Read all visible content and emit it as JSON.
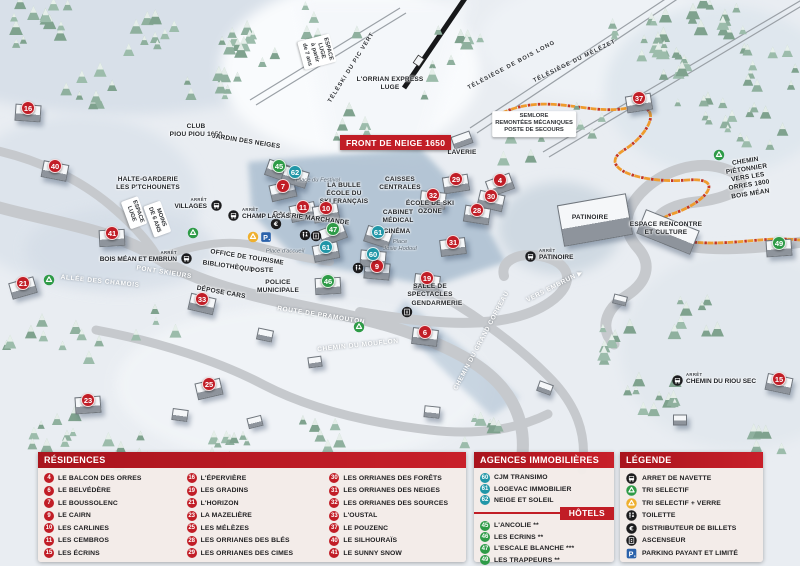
{
  "colors": {
    "red": "#c11d26",
    "green": "#2e9b47",
    "teal": "#2196a7",
    "yellow": "#efb02e",
    "blue": "#2b62ab",
    "orange": "#ef9b2d"
  },
  "map": {
    "banner": {
      "text": "FRONT DE NEIGE 1650"
    },
    "arret_label": "ARRÊT",
    "markers": [
      {
        "n": "16",
        "type": "residence",
        "x": 28,
        "y": 108
      },
      {
        "n": "40",
        "type": "residence",
        "x": 55,
        "y": 166
      },
      {
        "n": "41",
        "type": "residence",
        "x": 112,
        "y": 233
      },
      {
        "n": "21",
        "type": "residence",
        "x": 23,
        "y": 283
      },
      {
        "n": "33",
        "type": "residence",
        "x": 202,
        "y": 299
      },
      {
        "n": "23",
        "type": "residence",
        "x": 88,
        "y": 400
      },
      {
        "n": "25",
        "type": "residence",
        "x": 209,
        "y": 384
      },
      {
        "n": "7",
        "type": "residence",
        "x": 283,
        "y": 186
      },
      {
        "n": "11",
        "type": "residence",
        "x": 303,
        "y": 207
      },
      {
        "n": "10",
        "type": "residence",
        "x": 326,
        "y": 208
      },
      {
        "n": "9",
        "type": "residence",
        "x": 377,
        "y": 266
      },
      {
        "n": "29",
        "type": "residence",
        "x": 456,
        "y": 179
      },
      {
        "n": "4",
        "type": "residence",
        "x": 500,
        "y": 180
      },
      {
        "n": "32",
        "type": "residence",
        "x": 433,
        "y": 195
      },
      {
        "n": "30",
        "type": "residence",
        "x": 491,
        "y": 196
      },
      {
        "n": "28",
        "type": "residence",
        "x": 477,
        "y": 210
      },
      {
        "n": "31",
        "type": "residence",
        "x": 453,
        "y": 242
      },
      {
        "n": "19",
        "type": "residence",
        "x": 427,
        "y": 278
      },
      {
        "n": "6",
        "type": "residence",
        "x": 425,
        "y": 332
      },
      {
        "n": "37",
        "type": "residence",
        "x": 639,
        "y": 98
      },
      {
        "n": "15",
        "type": "residence",
        "x": 779,
        "y": 379
      },
      {
        "n": "45",
        "type": "hotel",
        "x": 279,
        "y": 166
      },
      {
        "n": "47",
        "type": "hotel",
        "x": 333,
        "y": 229
      },
      {
        "n": "46",
        "type": "hotel",
        "x": 328,
        "y": 281
      },
      {
        "n": "49",
        "type": "hotel",
        "x": 779,
        "y": 243
      },
      {
        "n": "62",
        "type": "agency",
        "x": 295,
        "y": 172
      },
      {
        "n": "61",
        "type": "agency",
        "x": 326,
        "y": 247
      },
      {
        "n": "61",
        "type": "agency",
        "x": 378,
        "y": 232
      },
      {
        "n": "60",
        "type": "agency",
        "x": 373,
        "y": 254
      }
    ],
    "labels": [
      {
        "text": "ESPACE\nLUGE\nà partir\nde 7 ans",
        "x": 317,
        "y": 52,
        "rot": 75,
        "style": "pill"
      },
      {
        "text": "TÉLÉSKI DU PIC VERT",
        "x": 352,
        "y": 68,
        "rot": -58,
        "style": "lift"
      },
      {
        "text": "L'ORRIAN EXPRESS\nLUGE",
        "x": 390,
        "y": 84,
        "rot": 0,
        "style": "dark"
      },
      {
        "text": "TÉLÉSIÈGE DE BOIS LONG",
        "x": 512,
        "y": 66,
        "rot": -28,
        "style": "lift"
      },
      {
        "text": "TÉLÉSIÈGE DU MÉLÉZET",
        "x": 575,
        "y": 62,
        "rot": -26,
        "style": "lift"
      },
      {
        "text": "SEMLORE\nREMONTÉES MÉCANIQUES\nPOSTE DE SECOURS",
        "x": 534,
        "y": 124,
        "rot": 0,
        "style": "pill"
      },
      {
        "text": "CLUB\nPIOU PIOU 1650",
        "x": 196,
        "y": 131,
        "rot": 0,
        "style": "dark"
      },
      {
        "text": "JARDIN DES NEIGES",
        "x": 246,
        "y": 142,
        "rot": 9,
        "style": "dark"
      },
      {
        "text": "HALTE-GARDERIE\nLES P'TCHOUNETS",
        "x": 148,
        "y": 184,
        "rot": 0,
        "style": "dark"
      },
      {
        "text": "ESPACE\nLUGE",
        "x": 134,
        "y": 213,
        "rot": 70,
        "style": "pill"
      },
      {
        "text": "MOINS\nDE 6 ANS",
        "x": 157,
        "y": 219,
        "rot": 70,
        "style": "pill"
      },
      {
        "text": "LAVERIE",
        "x": 462,
        "y": 153,
        "rot": 0,
        "style": "dark"
      },
      {
        "text": "CAISSES\nCENTRALES",
        "x": 400,
        "y": 184,
        "rot": 0,
        "style": "dark"
      },
      {
        "text": "ÉCOLE DE SKI\nOZONE",
        "x": 430,
        "y": 208,
        "rot": 0,
        "style": "dark"
      },
      {
        "text": "CABINET\nMÉDICAL",
        "x": 398,
        "y": 217,
        "rot": 0,
        "style": "dark"
      },
      {
        "text": "CINÉMA",
        "x": 397,
        "y": 232,
        "rot": 0,
        "style": "dark"
      },
      {
        "text": "Place\nJosie Hodoul",
        "x": 400,
        "y": 246,
        "rot": 0,
        "style": "place"
      },
      {
        "text": "LA BULLE\nÉCOLE DU\nSKI FRANÇAIS",
        "x": 344,
        "y": 194,
        "rot": 0,
        "style": "dark"
      },
      {
        "text": "Place du Festival",
        "x": 318,
        "y": 181,
        "rot": 0,
        "style": "place"
      },
      {
        "text": "GALERIE MARCHANDE",
        "x": 311,
        "y": 219,
        "rot": 7,
        "style": "dark"
      },
      {
        "text": "Place d'accueil",
        "x": 285,
        "y": 252,
        "rot": 0,
        "style": "place"
      },
      {
        "text": "OFFICE DE TOURISME",
        "x": 247,
        "y": 258,
        "rot": 9,
        "style": "dark"
      },
      {
        "text": "BIBLIOTHÈQUE",
        "x": 228,
        "y": 267,
        "rot": 8,
        "style": "dark"
      },
      {
        "text": "POSTE",
        "x": 262,
        "y": 271,
        "rot": 0,
        "style": "dark"
      },
      {
        "text": "POLICE\nMUNICIPALE",
        "x": 278,
        "y": 287,
        "rot": 0,
        "style": "dark"
      },
      {
        "text": "DÉPOSE CARS",
        "x": 221,
        "y": 293,
        "rot": 10,
        "style": "dark"
      },
      {
        "text": "SALLE DE\nSPECTACLES",
        "x": 430,
        "y": 291,
        "rot": 0,
        "style": "dark"
      },
      {
        "text": "GENDARMERIE",
        "x": 437,
        "y": 304,
        "rot": 0,
        "style": "dark"
      },
      {
        "text": "ALLÉE DES CHAMOIS",
        "x": 100,
        "y": 282,
        "rot": 6,
        "style": "road"
      },
      {
        "text": "PONT SKIEURS",
        "x": 164,
        "y": 273,
        "rot": 9,
        "style": "road"
      },
      {
        "text": "ROUTE DE PRAMOUTON",
        "x": 321,
        "y": 316,
        "rot": 9,
        "style": "road"
      },
      {
        "text": "CHEMIN DU MOUFLON",
        "x": 358,
        "y": 346,
        "rot": -6,
        "style": "road"
      },
      {
        "text": "CHEMIN DU GRAND CORREAU",
        "x": 482,
        "y": 341,
        "rot": -62,
        "style": "road"
      },
      {
        "text": "VERS EMBRUN ▶",
        "x": 555,
        "y": 287,
        "rot": -27,
        "style": "road"
      },
      {
        "text": "PATINOIRE",
        "x": 590,
        "y": 218,
        "rot": 0,
        "style": "dark"
      },
      {
        "text": "CHEMIN PIÉTONNIER\nVERS LES ORRES 1800\nBOIS MÉAN",
        "x": 748,
        "y": 178,
        "rot": -9,
        "style": "dark"
      },
      {
        "text": "ESPACE RENCONTRE\nET CULTURE",
        "x": 666,
        "y": 229,
        "rot": 0,
        "style": "dark"
      }
    ],
    "stops": [
      {
        "label": "VILLAGES",
        "x": 216,
        "y": 205,
        "side": "left"
      },
      {
        "label": "CHAMP LACAS",
        "x": 233,
        "y": 215,
        "side": "right"
      },
      {
        "label": "BOIS MÉAN ET EMBRUN",
        "x": 186,
        "y": 258,
        "side": "left"
      },
      {
        "label": "PATINOIRE",
        "x": 530,
        "y": 256,
        "side": "right"
      },
      {
        "label": "CHEMIN DU RIOU SEC",
        "x": 677,
        "y": 380,
        "side": "right"
      }
    ],
    "icons": [
      {
        "type": "recycle-green",
        "x": 49,
        "y": 280
      },
      {
        "type": "recycle-green",
        "x": 193,
        "y": 233
      },
      {
        "type": "recycle-green",
        "x": 359,
        "y": 327
      },
      {
        "type": "recycle-green",
        "x": 719,
        "y": 155
      },
      {
        "type": "recycle-yellow",
        "x": 253,
        "y": 237
      },
      {
        "type": "parking",
        "x": 266,
        "y": 237
      },
      {
        "type": "atm",
        "x": 276,
        "y": 224
      },
      {
        "type": "toilet",
        "x": 305,
        "y": 235
      },
      {
        "type": "elevator",
        "x": 316,
        "y": 236
      },
      {
        "type": "toilet",
        "x": 358,
        "y": 268
      },
      {
        "type": "elevator",
        "x": 407,
        "y": 312
      }
    ]
  },
  "legend": {
    "residences": {
      "title": "RÉSIDENCES",
      "columns": [
        [
          {
            "n": "4",
            "label": "LE BALCON DES ORRES"
          },
          {
            "n": "6",
            "label": "LE BELVÉDÈRE"
          },
          {
            "n": "7",
            "label": "LE BOUSSOLENC"
          },
          {
            "n": "9",
            "label": "LE CAIRN"
          },
          {
            "n": "10",
            "label": "LES CARLINES"
          },
          {
            "n": "11",
            "label": "LES CEMBROS"
          },
          {
            "n": "15",
            "label": "LES ÉCRINS"
          }
        ],
        [
          {
            "n": "16",
            "label": "L'ÉPERVIÈRE"
          },
          {
            "n": "19",
            "label": "LES GRADINS"
          },
          {
            "n": "21",
            "label": "L'HORIZON"
          },
          {
            "n": "23",
            "label": "LA MAZELIÈRE"
          },
          {
            "n": "25",
            "label": "LES MÉLÈZES"
          },
          {
            "n": "28",
            "label": "LES ORRIANES DES BLÉS"
          },
          {
            "n": "29",
            "label": "LES ORRIANES DES CIMES"
          }
        ],
        [
          {
            "n": "30",
            "label": "LES ORRIANES DES FORÊTS"
          },
          {
            "n": "31",
            "label": "LES ORRIANES DES NEIGES"
          },
          {
            "n": "32",
            "label": "LES ORRIANES DES SOURCES"
          },
          {
            "n": "33",
            "label": "L'OUSTAL"
          },
          {
            "n": "37",
            "label": "LE POUZENC"
          },
          {
            "n": "40",
            "label": "LE SILHOURAÏS"
          },
          {
            "n": "41",
            "label": "LE SUNNY SNOW"
          }
        ]
      ]
    },
    "agences": {
      "title": "AGENCES IMMOBILIÈRES",
      "items": [
        {
          "n": "60",
          "label": "CJM TRANSIMO"
        },
        {
          "n": "61",
          "label": "LOGEVAC IMMOBILIER"
        },
        {
          "n": "62",
          "label": "NEIGE ET SOLEIL"
        }
      ]
    },
    "hotels": {
      "title": "HÔTELS",
      "items": [
        {
          "n": "45",
          "label": "L'ANCOLIE **"
        },
        {
          "n": "46",
          "label": "LES ECRINS **"
        },
        {
          "n": "47",
          "label": "L'ESCALE BLANCHE ***"
        },
        {
          "n": "49",
          "label": "LES TRAPPEURS **"
        }
      ]
    },
    "legende": {
      "title": "LÉGENDE",
      "items": [
        {
          "icon": "bus",
          "label": "ARRET DE NAVETTE"
        },
        {
          "icon": "recycle-green",
          "label": "TRI SELECTIF"
        },
        {
          "icon": "recycle-yellow",
          "label": "TRI SELECTIF + VERRE"
        },
        {
          "icon": "toilet",
          "label": "TOILETTE"
        },
        {
          "icon": "atm",
          "label": "DISTRIBUTEUR DE BILLETS"
        },
        {
          "icon": "elevator",
          "label": "ASCENSEUR"
        },
        {
          "icon": "parking",
          "label": "PARKING PAYANT ET LIMITÉ"
        }
      ]
    }
  }
}
